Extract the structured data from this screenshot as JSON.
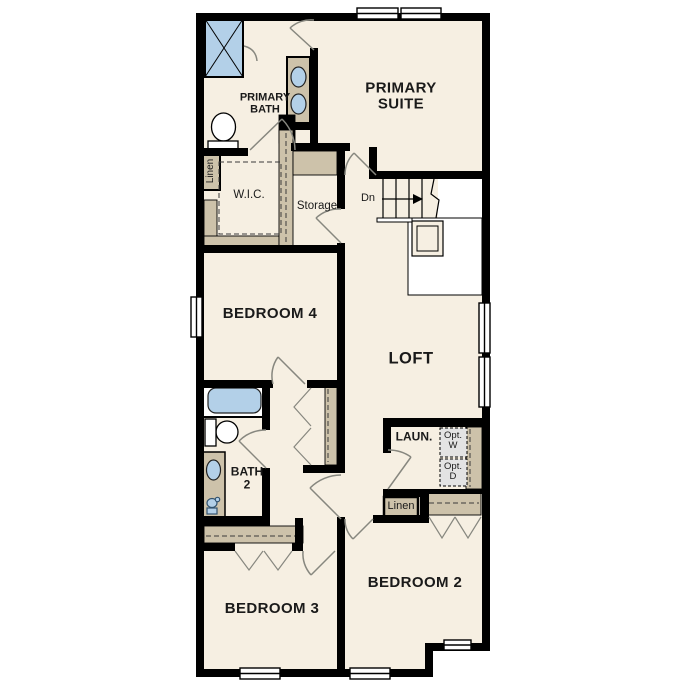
{
  "plan": {
    "title": "Second Floor Plan",
    "colors": {
      "floor": "#f6efe2",
      "wall": "#000000",
      "casework_tan": "#cdc2aa",
      "fixture_blue": "#b3d0e8",
      "optional_gray": "#e3e3e3",
      "stairwell_void": "#ffffff",
      "door_swing": "#87877f"
    },
    "rooms": {
      "primary_bath": {
        "line1": "PRIMARY",
        "line2": "BATH"
      },
      "primary_suite": {
        "line1": "PRIMARY",
        "line2": "SUITE"
      },
      "wic": {
        "label": "W.I.C."
      },
      "storage": {
        "label": "Storage"
      },
      "bedroom4": {
        "label": "BEDROOM 4"
      },
      "loft": {
        "label": "LOFT"
      },
      "bath2": {
        "line1": "BATH",
        "line2": "2"
      },
      "laundry": {
        "label": "LAUN."
      },
      "bedroom3": {
        "label": "BEDROOM 3"
      },
      "bedroom2": {
        "label": "BEDROOM 2"
      }
    },
    "closets": {
      "linen_upper": "Linen",
      "linen_lower": "Linen"
    },
    "stairs": {
      "direction": "Dn"
    },
    "appliances": {
      "opt_washer": {
        "line1": "Opt.",
        "line2": "W"
      },
      "opt_dryer": {
        "line1": "Opt.",
        "line2": "D"
      }
    },
    "fixtures": [
      "shower",
      "double-vanity-sink",
      "toilet",
      "bathtub",
      "vanity-sink"
    ]
  }
}
